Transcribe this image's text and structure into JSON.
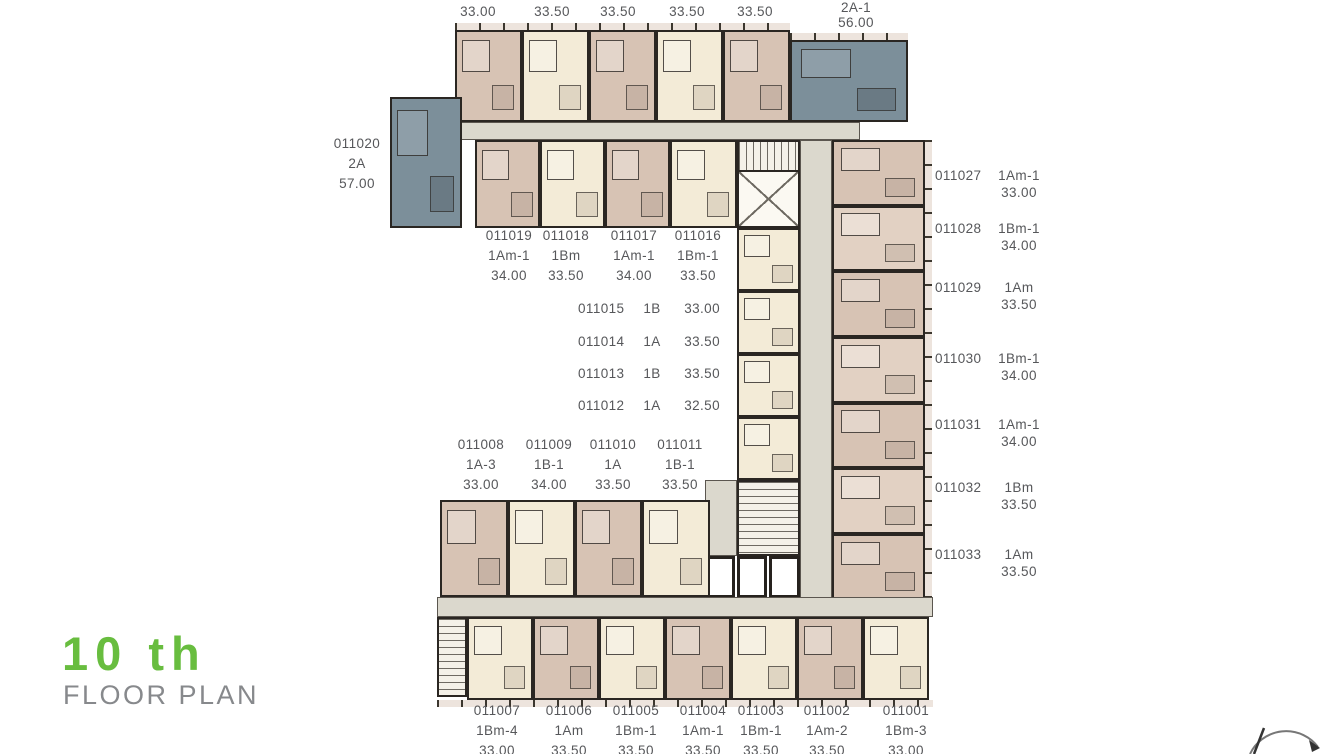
{
  "title": {
    "floor": "10 th",
    "label": "FLOOR PLAN"
  },
  "colors": {
    "accent_green": "#68bd3f",
    "title_gray": "#87898c",
    "unit_tan": "#d7c3b4",
    "unit_cream": "#f3ebd7",
    "unit_blue": "#7c8f9a",
    "corridor_gray": "#dbd8cd",
    "label_text": "#56575a"
  },
  "top_wing": {
    "sizes": [
      "33.00",
      "33.50",
      "33.50",
      "33.50",
      "33.50"
    ],
    "corner_unit": {
      "type": "2A-1",
      "size": "56.00"
    }
  },
  "left_unit": {
    "no": "011020",
    "type": "2A",
    "size": "57.00"
  },
  "upper_row": [
    {
      "no": "011019",
      "type": "1Am-1",
      "size": "34.00"
    },
    {
      "no": "011018",
      "type": "1Bm",
      "size": "33.50"
    },
    {
      "no": "011017",
      "type": "1Am-1",
      "size": "34.00"
    },
    {
      "no": "011016",
      "type": "1Bm-1",
      "size": "33.50"
    }
  ],
  "inner_column": [
    {
      "no": "011015",
      "type": "1B",
      "size": "33.00"
    },
    {
      "no": "011014",
      "type": "1A",
      "size": "33.50"
    },
    {
      "no": "011013",
      "type": "1B",
      "size": "33.50"
    },
    {
      "no": "011012",
      "type": "1A",
      "size": "32.50"
    }
  ],
  "lower_row": [
    {
      "no": "011008",
      "type": "1A-3",
      "size": "33.00"
    },
    {
      "no": "011009",
      "type": "1B-1",
      "size": "34.00"
    },
    {
      "no": "011010",
      "type": "1A",
      "size": "33.50"
    },
    {
      "no": "011011",
      "type": "1B-1",
      "size": "33.50"
    }
  ],
  "right_column": [
    {
      "no": "011027",
      "type": "1Am-1",
      "size": "33.00"
    },
    {
      "no": "011028",
      "type": "1Bm-1",
      "size": "34.00"
    },
    {
      "no": "011029",
      "type": "1Am",
      "size": "33.50"
    },
    {
      "no": "011030",
      "type": "1Bm-1",
      "size": "34.00"
    },
    {
      "no": "011031",
      "type": "1Am-1",
      "size": "34.00"
    },
    {
      "no": "011032",
      "type": "1Bm",
      "size": "33.50"
    },
    {
      "no": "011033",
      "type": "1Am",
      "size": "33.50"
    }
  ],
  "bottom_row": [
    {
      "no": "011007",
      "type": "1Bm-4",
      "size": "33.00"
    },
    {
      "no": "011006",
      "type": "1Am",
      "size": "33.50"
    },
    {
      "no": "011005",
      "type": "1Bm-1",
      "size": "33.50"
    },
    {
      "no": "011004",
      "type": "1Am-1",
      "size": "33.50"
    },
    {
      "no": "011003",
      "type": "1Bm-1",
      "size": "33.50"
    },
    {
      "no": "011002",
      "type": "1Am-2",
      "size": "33.50"
    },
    {
      "no": "011001",
      "type": "1Bm-3",
      "size": "33.00"
    }
  ]
}
